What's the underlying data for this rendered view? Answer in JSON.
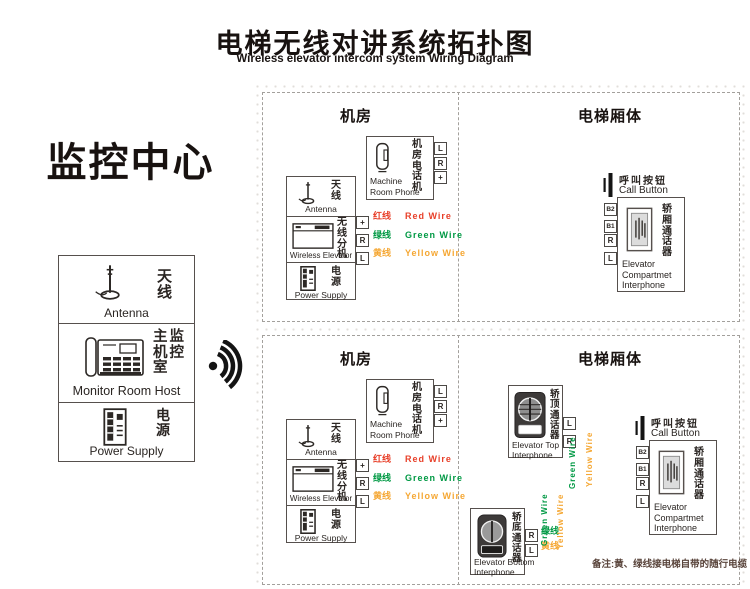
{
  "title": {
    "zh": "电梯无线对讲系统拓扑图",
    "en": "Wireless elevator intercom system Wiring Diagram"
  },
  "monitor_center": {
    "heading": "监控中心",
    "antenna": {
      "zh": "天线",
      "en": "Antenna"
    },
    "host": {
      "zh": "主监机控室",
      "en": "Monitor Room Host"
    },
    "power": {
      "zh": "电源",
      "en": "Power Supply"
    }
  },
  "headers": {
    "machine_room": "机房",
    "car_body": "电梯厢体"
  },
  "devices": {
    "phone": {
      "zh": "机房电话机",
      "en1": "Machine",
      "en2": "Room Phone"
    },
    "antenna": {
      "zh": "天线",
      "en": "Antenna"
    },
    "wireless": {
      "zh": "无线分机",
      "en": "Wireless Elevator"
    },
    "power": {
      "zh": "电源",
      "en": "Power Supply"
    },
    "call_button": {
      "zh": "呼叫按钮",
      "en": "Call Button"
    },
    "compartment": {
      "zh": "轿厢通话器",
      "en1": "Elevator",
      "en2": "Compartmet",
      "en3": "Interphone"
    },
    "top_interphone": {
      "zh": "轿顶通话器",
      "en1": "Elevator Top",
      "en2": "Interphone"
    },
    "bottom_interphone": {
      "zh": "轿底通话器",
      "en1": "Elevator Bottom",
      "en2": "Interphone"
    }
  },
  "wires": {
    "red": {
      "zh": "红线",
      "en": "Red Wire",
      "color": "#e8402a"
    },
    "green": {
      "zh": "绿线",
      "en": "Green Wire",
      "color": "#009944"
    },
    "yellow": {
      "zh": "黄线",
      "en": "Yellow Wire",
      "color": "#f5a733"
    }
  },
  "terminals": {
    "plus": "+",
    "r": "R",
    "l": "L",
    "b1": "B1",
    "b2": "B2"
  },
  "note": "备注:黄、绿线接电梯自带的随行电缆"
}
